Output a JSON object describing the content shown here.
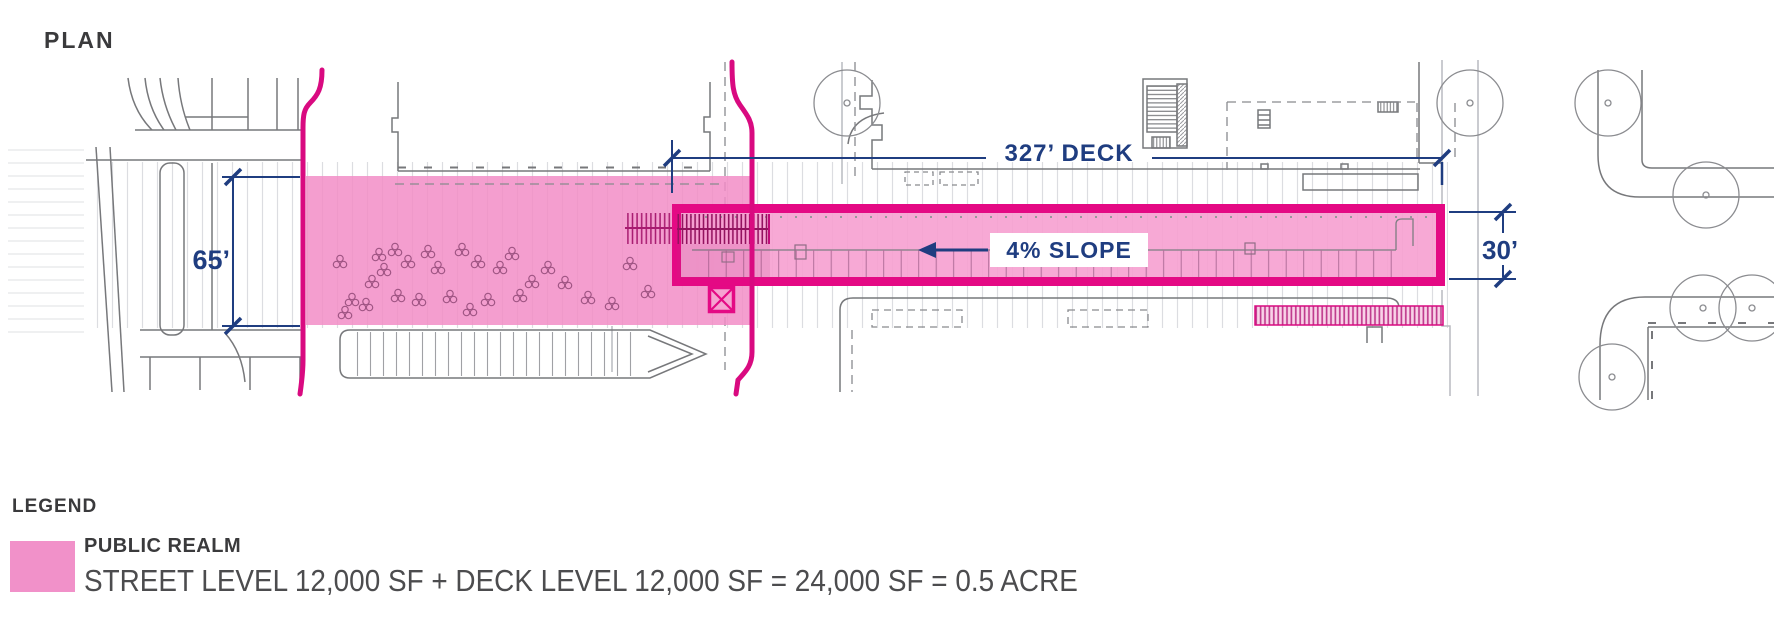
{
  "page": {
    "title": "PLAN"
  },
  "plan": {
    "annotations": {
      "street_width": "65’",
      "deck_length": "327’ DECK",
      "deck_width": "30’",
      "slope": "4% SLOPE"
    }
  },
  "legend": {
    "heading": "LEGEND",
    "items": [
      {
        "label": "PUBLIC REALM",
        "detail": "STREET LEVEL 12,000 SF + DECK LEVEL 12,000 SF = 24,000 SF = 0.5 ACRE",
        "swatch_color": "#F191C9"
      }
    ]
  },
  "colors": {
    "public_realm_pink": "#F292C8",
    "deck_fill_pink": "#F6A0D0",
    "outline_magenta": "#E40984",
    "dimension_navy": "#1F3D80",
    "heading_dark": "#3A3A3C",
    "linework_gray": "#77787B"
  }
}
